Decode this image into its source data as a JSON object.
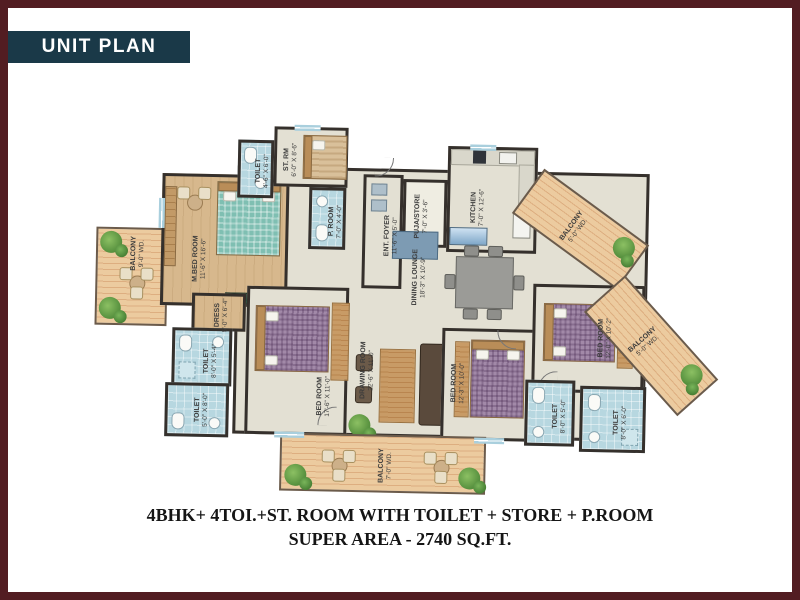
{
  "frame": {
    "badge": "UNIT PLAN"
  },
  "caption": {
    "line1": "4BHK+ 4TOI.+ST. ROOM WITH TOILET + STORE + P.ROOM",
    "line2": "SUPER AREA - 2740 SQ.FT."
  },
  "colors": {
    "border": "#521d22",
    "badge_bg": "#1a3948",
    "badge_text": "#ffffff",
    "floor": "#e3e0d3",
    "wood_floor": "#d7b88d",
    "toilet_tile": "#b7d7e0",
    "deck": "#eccb9f",
    "wall": "#35302c",
    "plant": "#4e8c3a",
    "master_bed": "#7fbfb2",
    "guest_bed": "#a289a8",
    "dining_set": "#9b9b97"
  },
  "rooms": {
    "m_bedroom": {
      "name": "M.BED ROOM",
      "dims": "11'-6\" X 16'-6\""
    },
    "toilet_master": {
      "name": "TOILET",
      "dims": "4'-6\" X 6'-0\""
    },
    "st_room": {
      "name": "ST. RM",
      "dims": "6'-0\" X 8'-6\""
    },
    "p_room": {
      "name": "P. ROOM",
      "dims": "7'-0\" X 4'-0\""
    },
    "ent_foyer": {
      "name": "ENT. FOYER",
      "dims": "11'-6\" X 5'-0\""
    },
    "puja_store": {
      "name": "PUJA/STORE",
      "dims": "7'-0\" X 3'-6\""
    },
    "kitchen": {
      "name": "KITCHEN",
      "dims": "7'-0\" X 12'-6\""
    },
    "balcony_kitchen": {
      "name": "BALCONY",
      "dims": "5'-0\" WD."
    },
    "balcony_left": {
      "name": "BALCONY",
      "dims": "9'-0\" WD."
    },
    "dress": {
      "name": "DRESS",
      "dims": "5'-0\" X 6'-4\""
    },
    "toilet_master2": {
      "name": "TOILET",
      "dims": "8'-0\" X 5'-4\""
    },
    "toilet_bed1": {
      "name": "TOILET",
      "dims": "5'-0\" X 8'-0\""
    },
    "dining_lounge": {
      "name": "DINING LOUNGE",
      "dims": "18'-3\" X 10'-9\""
    },
    "drawing_room": {
      "name": "DRAWING ROOM",
      "dims": "22'-6\" X 11'-0\""
    },
    "bedroom1": {
      "name": "BED ROOM",
      "dims": "17'-6\" X 11'-0\""
    },
    "bedroom2": {
      "name": "BED ROOM",
      "dims": "12'-3\" X 10'-0\""
    },
    "bedroom3": {
      "name": "BED ROOM",
      "dims": "12'-0\" X 10'-2\""
    },
    "toilet_bed2": {
      "name": "TOILET",
      "dims": "8'-0\" X 5'-0\""
    },
    "toilet_bed3": {
      "name": "TOILET",
      "dims": "8'-0\" X 6'-0\""
    },
    "balcony_right": {
      "name": "BALCONY",
      "dims": "5'-0\" WD."
    },
    "balcony_bottom": {
      "name": "BALCONY",
      "dims": "7'-0\" WD."
    }
  }
}
